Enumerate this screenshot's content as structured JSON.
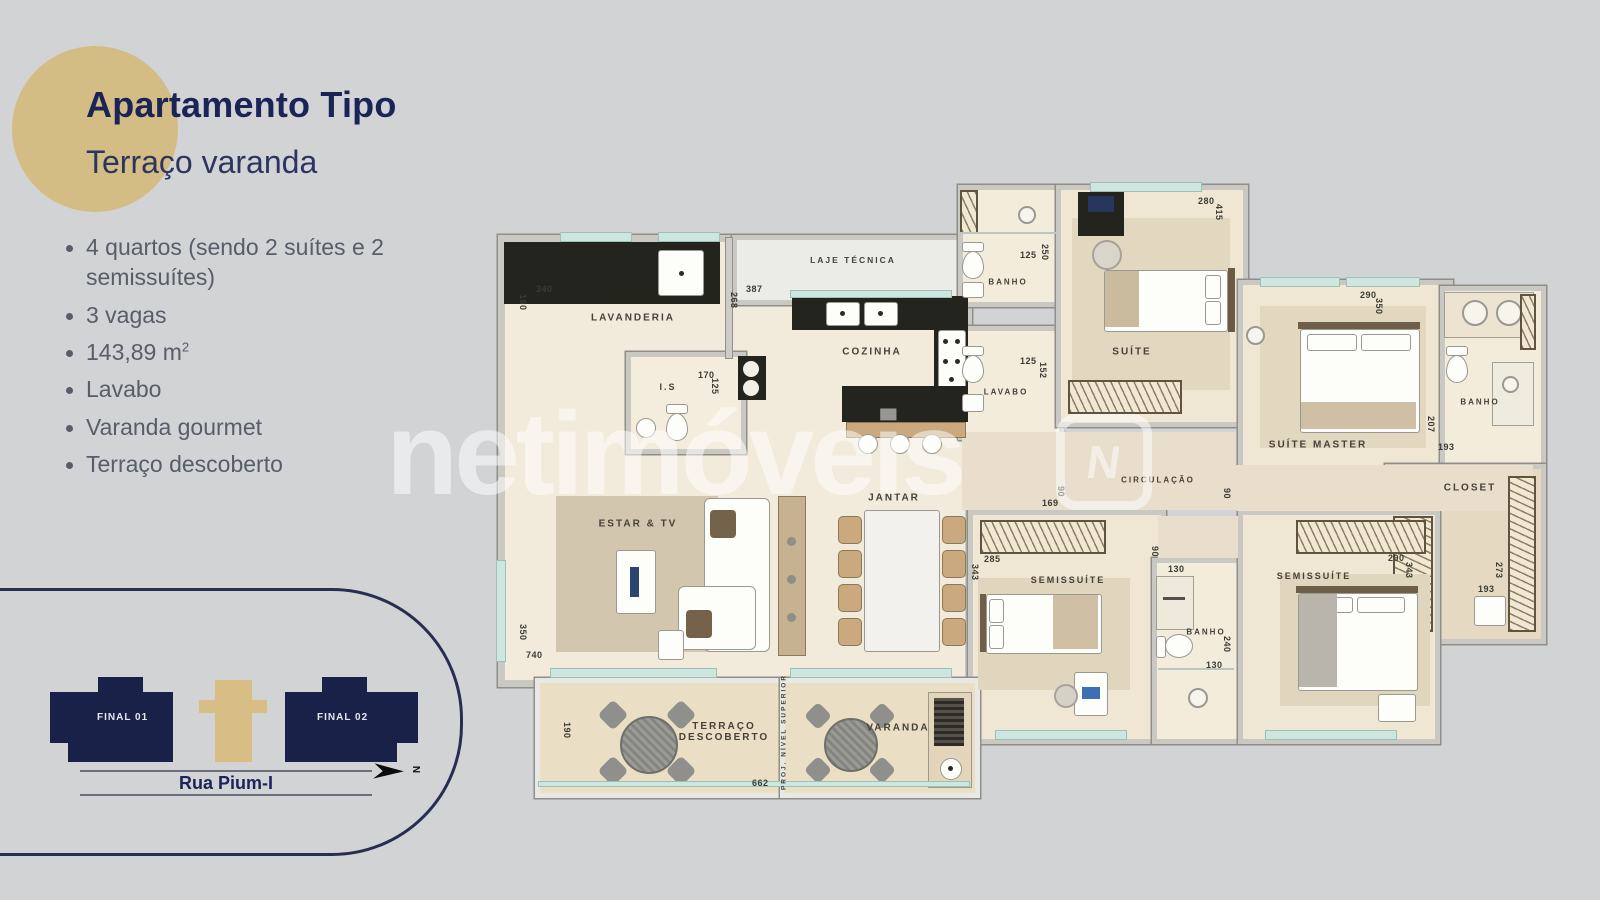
{
  "header": {
    "title": "Apartamento Tipo",
    "subtitle": "Terraço varanda"
  },
  "features": [
    {
      "text": "4 quartos (sendo 2 suítes e 2 semissuítes)"
    },
    {
      "text": "3 vagas"
    },
    {
      "text": "143,89 m",
      "sup": "2"
    },
    {
      "text": "Lavabo"
    },
    {
      "text": "Varanda gourmet"
    },
    {
      "text": "Terraço descoberto"
    }
  ],
  "site_plan": {
    "final_01": "FINAL 01",
    "final_02": "FINAL 02",
    "street": "Rua Pium-I",
    "north_label": "N"
  },
  "watermark": {
    "text": "netimóveis",
    "logo_letter": "N"
  },
  "floor_plan": {
    "room_labels": [
      {
        "id": "lavanderia",
        "label": "LAVANDERIA",
        "x": 143,
        "y": 138
      },
      {
        "id": "laje-tecnica",
        "label": "LAJE TÉCNICA",
        "x": 363,
        "y": 80,
        "size": 8.5
      },
      {
        "id": "cozinha",
        "label": "COZINHA",
        "x": 382,
        "y": 172
      },
      {
        "id": "is",
        "label": "I.S",
        "x": 178,
        "y": 207,
        "size": 9
      },
      {
        "id": "banho-1",
        "label": "BANHO",
        "x": 518,
        "y": 102,
        "size": 8
      },
      {
        "id": "suite",
        "label": "SUÍTE",
        "x": 642,
        "y": 172
      },
      {
        "id": "lavabo",
        "label": "LAVABO",
        "x": 516,
        "y": 212,
        "size": 8
      },
      {
        "id": "circulacao",
        "label": "CIRCULAÇÃO",
        "x": 668,
        "y": 300,
        "size": 8
      },
      {
        "id": "suite-master",
        "label": "SUÍTE MASTER",
        "x": 828,
        "y": 265
      },
      {
        "id": "banho-master",
        "label": "BANHO",
        "x": 990,
        "y": 222,
        "size": 8
      },
      {
        "id": "closet",
        "label": "CLOSET",
        "x": 980,
        "y": 308
      },
      {
        "id": "estar-tv",
        "label": "ESTAR & TV",
        "x": 148,
        "y": 344
      },
      {
        "id": "jantar",
        "label": "JANTAR",
        "x": 404,
        "y": 318
      },
      {
        "id": "semissuite-1",
        "label": "SEMISSUÍTE",
        "x": 578,
        "y": 400,
        "size": 9
      },
      {
        "id": "banho-2",
        "label": "BANHO",
        "x": 716,
        "y": 452,
        "size": 8
      },
      {
        "id": "semissuite-2",
        "label": "SEMISSUÍTE",
        "x": 824,
        "y": 396,
        "size": 9
      },
      {
        "id": "terraco",
        "label": "TERRAÇO\nDESCOBERTO",
        "x": 234,
        "y": 552
      },
      {
        "id": "varanda",
        "label": "VARANDA",
        "x": 408,
        "y": 548
      },
      {
        "id": "proj-nivel-superior",
        "label": "PROJ. NÍVEL SUPERIOR",
        "x": 294,
        "y": 552,
        "vert": 1,
        "size": 6.5
      }
    ],
    "dimensions": [
      {
        "v": "340",
        "x": 46,
        "y": 104
      },
      {
        "v": "160",
        "x": 38,
        "y": 114,
        "vert": 1
      },
      {
        "v": "387",
        "x": 256,
        "y": 104
      },
      {
        "v": "268",
        "x": 249,
        "y": 112,
        "vert": 1
      },
      {
        "v": "170",
        "x": 208,
        "y": 190
      },
      {
        "v": "125",
        "x": 230,
        "y": 198,
        "vert": 1
      },
      {
        "v": "125",
        "x": 530,
        "y": 70
      },
      {
        "v": "250",
        "x": 560,
        "y": 64,
        "vert": 1
      },
      {
        "v": "280",
        "x": 708,
        "y": 16
      },
      {
        "v": "415",
        "x": 734,
        "y": 24,
        "vert": 1
      },
      {
        "v": "125",
        "x": 530,
        "y": 176
      },
      {
        "v": "152",
        "x": 558,
        "y": 182,
        "vert": 1
      },
      {
        "v": "290",
        "x": 870,
        "y": 110
      },
      {
        "v": "350",
        "x": 894,
        "y": 118,
        "vert": 1
      },
      {
        "v": "207",
        "x": 946,
        "y": 236,
        "vert": 1
      },
      {
        "v": "193",
        "x": 948,
        "y": 262
      },
      {
        "v": "193",
        "x": 988,
        "y": 404
      },
      {
        "v": "273",
        "x": 1014,
        "y": 382,
        "vert": 1
      },
      {
        "v": "169",
        "x": 552,
        "y": 318
      },
      {
        "v": "90",
        "x": 576,
        "y": 306,
        "vert": 1
      },
      {
        "v": "90",
        "x": 742,
        "y": 308,
        "vert": 1
      },
      {
        "v": "90",
        "x": 670,
        "y": 366,
        "vert": 1
      },
      {
        "v": "130",
        "x": 678,
        "y": 384
      },
      {
        "v": "130",
        "x": 716,
        "y": 480
      },
      {
        "v": "240",
        "x": 742,
        "y": 456,
        "vert": 1
      },
      {
        "v": "285",
        "x": 494,
        "y": 374
      },
      {
        "v": "343",
        "x": 490,
        "y": 384,
        "vert": 1
      },
      {
        "v": "290",
        "x": 898,
        "y": 373
      },
      {
        "v": "343",
        "x": 924,
        "y": 382,
        "vert": 1
      },
      {
        "v": "350",
        "x": 38,
        "y": 444,
        "vert": 1
      },
      {
        "v": "740",
        "x": 36,
        "y": 470
      },
      {
        "v": "190",
        "x": 82,
        "y": 542,
        "vert": 1
      },
      {
        "v": "662",
        "x": 262,
        "y": 598
      }
    ]
  }
}
